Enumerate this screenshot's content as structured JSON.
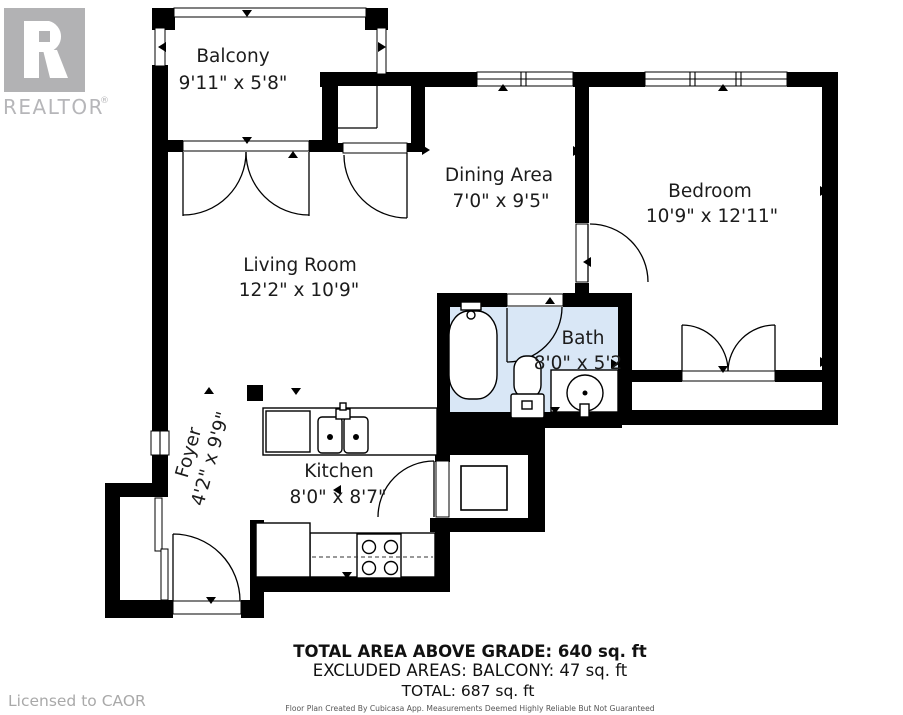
{
  "branding": {
    "logo_letter": "R",
    "logo_text": "REALTOR",
    "registered": "®",
    "licensed_text": "Licensed to CAOR"
  },
  "rooms": [
    {
      "name": "Balcony",
      "dims": "9'11\" x 5'8\""
    },
    {
      "name": "Dining Area",
      "dims": "7'0\" x 9'5\""
    },
    {
      "name": "Bedroom",
      "dims": "10'9\" x 12'11\""
    },
    {
      "name": "Living Room",
      "dims": "12'2\" x 10'9\""
    },
    {
      "name": "Bath",
      "dims": "8'0\" x 5'2"
    },
    {
      "name": "Kitchen",
      "dims": "8'0\" x 8'7\""
    },
    {
      "name": "Foyer",
      "dims": "4'2\" x 9'9\""
    }
  ],
  "summary": {
    "total_above_grade": "TOTAL AREA ABOVE GRADE: 640 sq. ft",
    "excluded_areas": "EXCLUDED AREAS: BALCONY: 47 sq. ft",
    "total": "TOTAL: 687 sq. ft",
    "disclaimer": "Floor Plan Created By Cubicasa App. Measurements Deemed Highly Reliable But Not Guaranteed"
  },
  "colors": {
    "wall": "#000000",
    "bath_fill": "#d9e7f6",
    "logo_gray": "#b2b2b4",
    "muted_text": "#a9a9a9",
    "label_text": "#1c1c1c"
  }
}
